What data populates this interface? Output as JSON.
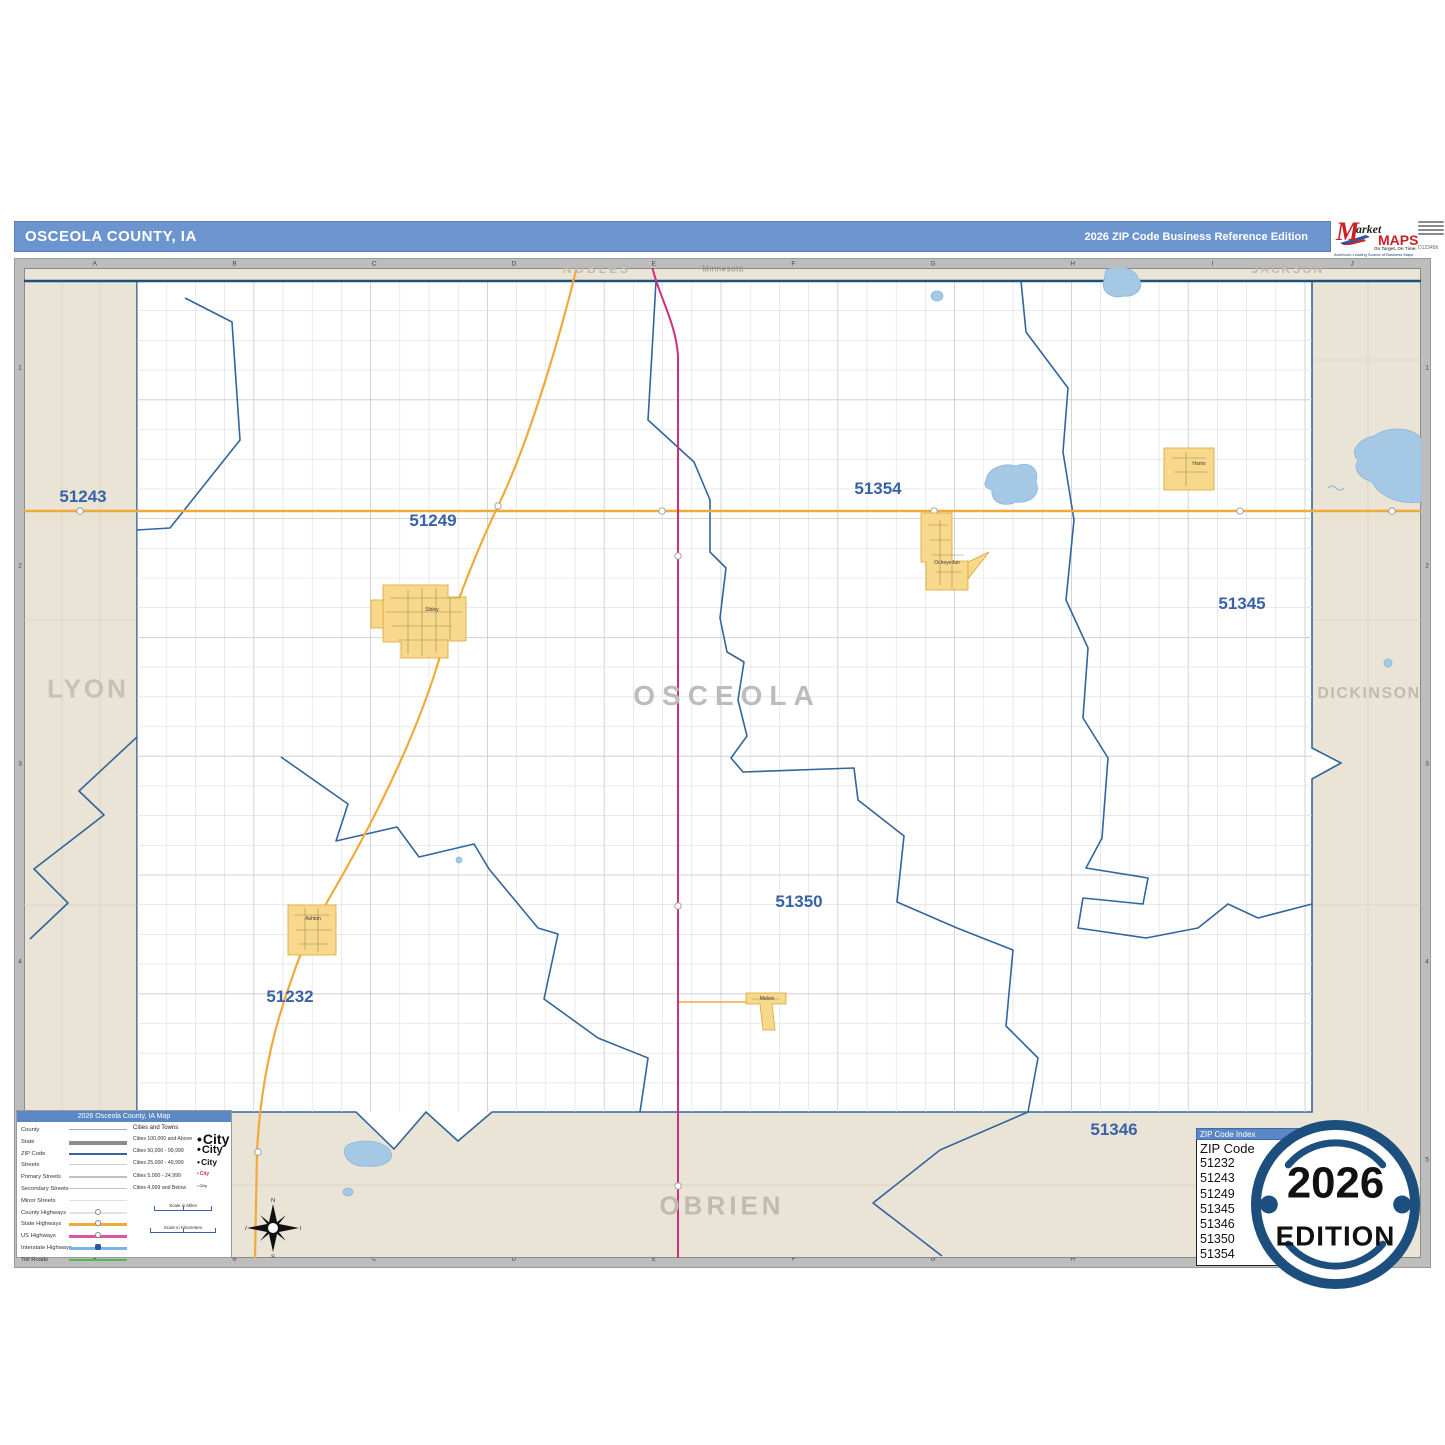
{
  "header": {
    "title": "OSCEOLA COUNTY, IA",
    "edition_label": "2026 ZIP Code Business Reference Edition"
  },
  "logo": {
    "m": "M",
    "market": "arket",
    "maps": "MAPS",
    "tagline": "On Target.  On Time.",
    "subtitle": "America's Leading Source of Business Maps",
    "code": "D123456"
  },
  "frame": {
    "columns": [
      "A",
      "B",
      "C",
      "D",
      "E",
      "F",
      "G",
      "H",
      "I",
      "J"
    ],
    "rows": [
      "1",
      "2",
      "3",
      "4",
      "5"
    ]
  },
  "map": {
    "county_label": "OSCEOLA",
    "neighbors": {
      "top_left": "NOBLES",
      "state_top": "Minnesota",
      "top_right": "JACKSON",
      "west": "LYON",
      "east": "DICKINSON",
      "south": "OBRIEN"
    },
    "zip_labels": [
      {
        "text": "51243"
      },
      {
        "text": "51249"
      },
      {
        "text": "51354"
      },
      {
        "text": "51345"
      },
      {
        "text": "51350"
      },
      {
        "text": "51232"
      },
      {
        "text": "51346"
      }
    ],
    "cities": [
      {
        "name": "Sibley"
      },
      {
        "name": "Ocheyedan"
      },
      {
        "name": "Ashton"
      },
      {
        "name": "Harris"
      },
      {
        "name": "Melvin"
      }
    ]
  },
  "legend": {
    "title": "2026 Osceola County, IA Map",
    "items": [
      {
        "label": "County"
      },
      {
        "label": "State"
      },
      {
        "label": "ZIP Code"
      },
      {
        "label": "Streets"
      },
      {
        "label": "Primary Streets"
      },
      {
        "label": "Secondary Streets"
      },
      {
        "label": "Minor Streets"
      },
      {
        "label": "County Highways"
      },
      {
        "label": "State Highways"
      },
      {
        "label": "US Highways"
      },
      {
        "label": "Interstate Highways"
      },
      {
        "label": "Toll Roads"
      }
    ],
    "cities_header": "Cities and Towns",
    "city_classes": [
      {
        "label": "Cities 100,000 and Above",
        "sample": "City"
      },
      {
        "label": "Cities 50,000 - 99,999",
        "sample": "City"
      },
      {
        "label": "Cities 25,000 - 49,999",
        "sample": "City"
      },
      {
        "label": "Cities 5,000 - 24,999",
        "sample": "City"
      },
      {
        "label": "Cities 4,999 and Below",
        "sample": "City"
      }
    ],
    "scale_miles": "Scale in Miles",
    "scale_km": "Scale in Kilometers"
  },
  "zip_index": {
    "title": "ZIP Code Index",
    "header": "ZIP Code",
    "codes": [
      "51232",
      "51243",
      "51249",
      "51345",
      "51346",
      "51350",
      "51354"
    ]
  },
  "badge": {
    "year": "2026",
    "edition": "EDITION"
  },
  "colors": {
    "header_blue": "#6c95d0",
    "boundary_blue": "#31659c",
    "highway_orange": "#f2a93b",
    "highway_magenta": "#cf2f80",
    "city_yellow": "#f8d88a",
    "lake_blue": "#a5c8e4",
    "badge_navy": "#1c4e7e"
  }
}
